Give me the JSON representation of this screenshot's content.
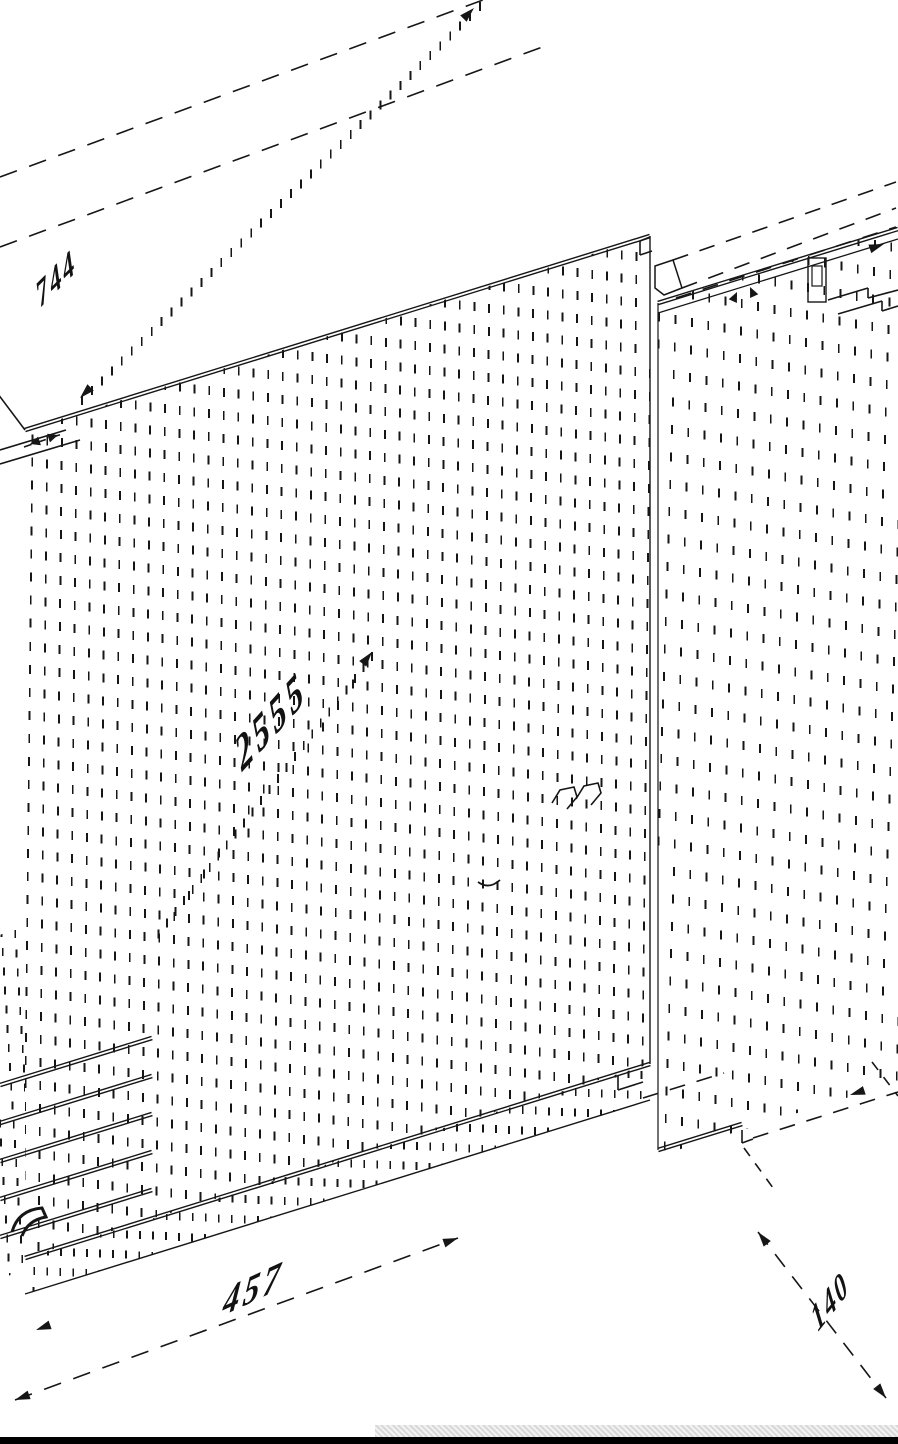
{
  "drawing": {
    "kind": "isometric cabinet technical drawing",
    "line_color": "#161616",
    "background": "#ffffff",
    "dimension_labels": {
      "top_left": "744",
      "center": "2555",
      "bottom": "457",
      "bottom_right": "140"
    }
  },
  "footer": {
    "black_bar_color": "#000000",
    "texture_strip_color": "#e9e9e9"
  }
}
